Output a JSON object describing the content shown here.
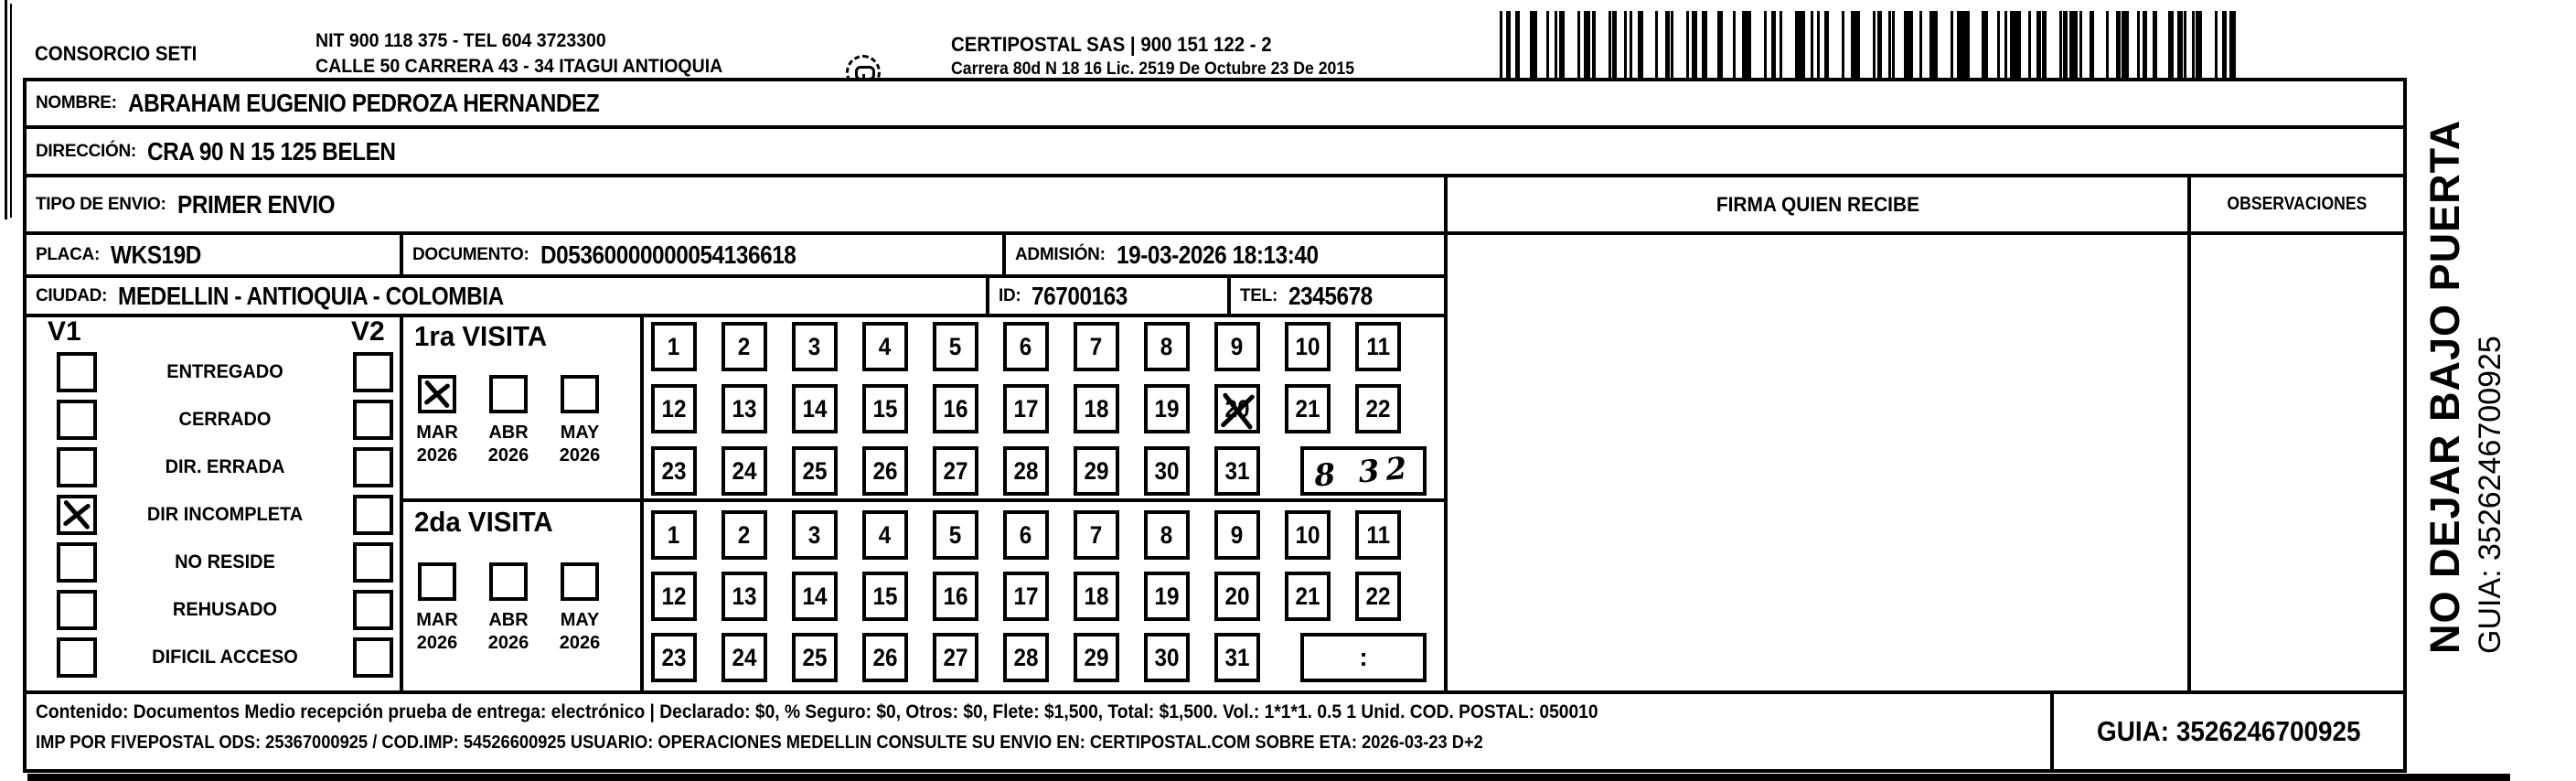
{
  "header": {
    "company": "CONSORCIO SETI",
    "nit_line": "NIT 900 118 375 - TEL 604 3723300",
    "address_line": "CALLE 50 CARRERA 43 - 34 ITAGUI ANTIOQUIA",
    "logo_caption": "CERTIPOSTAL",
    "certipostal_line": "CERTIPOSTAL SAS | 900 151 122 - 2",
    "license_line": "Carrera 80d N 18 16  Lic. 2519 De Octubre 23 De 2015"
  },
  "recipient": {
    "nombre_label": "NOMBRE:",
    "nombre": "ABRAHAM EUGENIO PEDROZA HERNANDEZ",
    "direccion_label": "DIRECCIÓN:",
    "direccion": "CRA 90 N 15 125 BELEN",
    "tipo_envio_label": "TIPO DE ENVIO:",
    "tipo_envio": "PRIMER ENVIO",
    "placa_label": "PLACA:",
    "placa": "WKS19D",
    "documento_label": "DOCUMENTO:",
    "documento": "D05360000000054136618",
    "admision_label": "ADMISIÓN:",
    "admision": "19-03-2026 18:13:40",
    "ciudad_label": "CIUDAD:",
    "ciudad": "MEDELLIN - ANTIOQUIA - COLOMBIA",
    "id_label": "ID:",
    "id": "76700163",
    "tel_label": "TEL:",
    "tel": "2345678"
  },
  "firma": {
    "header": "FIRMA QUIEN RECIBE"
  },
  "observaciones": {
    "header": "OBSERVACIONES"
  },
  "status_panel": {
    "v1_label": "V1",
    "v2_label": "V2",
    "rows": [
      {
        "label": "ENTREGADO",
        "v1": false,
        "v2": false
      },
      {
        "label": "CERRADO",
        "v1": false,
        "v2": false
      },
      {
        "label": "DIR. ERRADA",
        "v1": false,
        "v2": false
      },
      {
        "label": "DIR INCOMPLETA",
        "v1": true,
        "v2": false
      },
      {
        "label": "NO RESIDE",
        "v1": false,
        "v2": false
      },
      {
        "label": "REHUSADO",
        "v1": false,
        "v2": false
      },
      {
        "label": "DIFICIL ACCESO",
        "v1": false,
        "v2": false
      }
    ]
  },
  "visit1": {
    "title": "1ra VISITA",
    "months": [
      {
        "month": "MAR",
        "year": "2026",
        "checked": true
      },
      {
        "month": "ABR",
        "year": "2026",
        "checked": false
      },
      {
        "month": "MAY",
        "year": "2026",
        "checked": false
      }
    ],
    "days_row1": [
      "1",
      "2",
      "3",
      "4",
      "5",
      "6",
      "7",
      "8",
      "9",
      "10",
      "11"
    ],
    "days_row2": [
      "12",
      "13",
      "14",
      "15",
      "16",
      "17",
      "18",
      "19",
      "20",
      "21",
      "22"
    ],
    "days_row3": [
      "23",
      "24",
      "25",
      "26",
      "27",
      "28",
      "29",
      "30",
      "31"
    ],
    "crossed_day": "20",
    "time_entry": "8 32"
  },
  "visit2": {
    "title": "2da VISITA",
    "months": [
      {
        "month": "MAR",
        "year": "2026",
        "checked": false
      },
      {
        "month": "ABR",
        "year": "2026",
        "checked": false
      },
      {
        "month": "MAY",
        "year": "2026",
        "checked": false
      }
    ],
    "days_row1": [
      "1",
      "2",
      "3",
      "4",
      "5",
      "6",
      "7",
      "8",
      "9",
      "10",
      "11"
    ],
    "days_row2": [
      "12",
      "13",
      "14",
      "15",
      "16",
      "17",
      "18",
      "19",
      "20",
      "21",
      "22"
    ],
    "days_row3": [
      "23",
      "24",
      "25",
      "26",
      "27",
      "28",
      "29",
      "30",
      "31"
    ],
    "time_entry": ":"
  },
  "footer": {
    "line1": "Contenido: Documentos Medio recepción prueba de entrega: electrónico | Declarado: $0, % Seguro: $0, Otros: $0, Flete: $1,500, Total: $1,500. Vol.: 1*1*1. 0.5  1 Unid. COD. POSTAL: 050010",
    "line2": "IMP POR FIVEPOSTAL ODS: 25367000925 / COD.IMP: 54526600925 USUARIO: OPERACIONES MEDELLIN CONSULTE SU ENVIO EN: CERTIPOSTAL.COM SOBRE ETA: 2026-03-23 D+2",
    "guia": "GUIA: 3526246700925"
  },
  "side": {
    "line1": "NO DEJAR BAJO PUERTA",
    "line2": "GUIA: 3526246700925"
  }
}
